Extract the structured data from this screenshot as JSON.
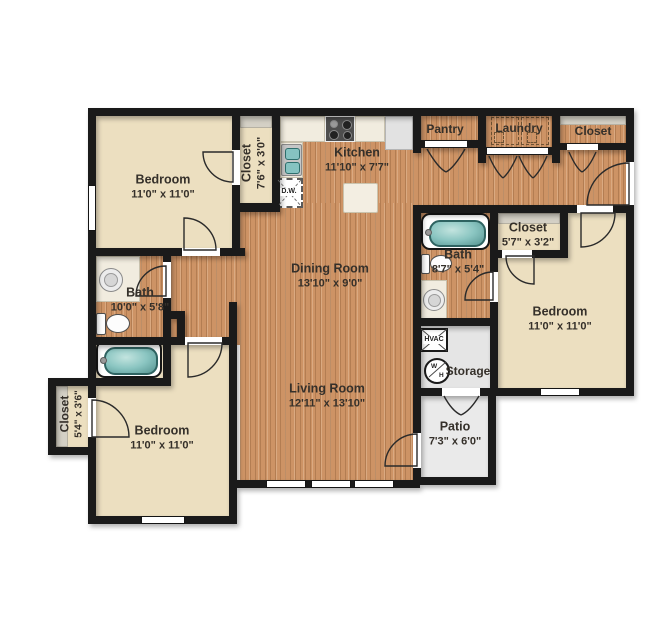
{
  "rooms": {
    "bedroom_tl": {
      "name": "Bedroom",
      "dims": "11'0\" x 11'0\""
    },
    "closet_tl": {
      "name": "Closet",
      "dims": "7'6\" x 3'0\""
    },
    "kitchen": {
      "name": "Kitchen",
      "dims": "11'10\" x 7'7\""
    },
    "pantry": {
      "name": "Pantry"
    },
    "laundry": {
      "name": "Laundry"
    },
    "closet_tr": {
      "name": "Closet"
    },
    "dining": {
      "name": "Dining Room",
      "dims": "13'10\" x 9'0\""
    },
    "living": {
      "name": "Living Room",
      "dims": "12'11\" x 13'10\""
    },
    "bath_l": {
      "name": "Bath",
      "dims": "10'0\" x 5'8\""
    },
    "bath_r": {
      "name": "Bath",
      "dims": "8'7\" x 5'4\""
    },
    "closet_r": {
      "name": "Closet",
      "dims": "5'7\" x 3'2\""
    },
    "bedroom_r": {
      "name": "Bedroom",
      "dims": "11'0\" x 11'0\""
    },
    "storage": {
      "name": "Storage"
    },
    "patio": {
      "name": "Patio",
      "dims": "7'3\" x 6'0\""
    },
    "closet_bl": {
      "name": "Closet",
      "dims": "5'4\" x 3'6\""
    },
    "bedroom_bl": {
      "name": "Bedroom",
      "dims": "11'0\" x 11'0\""
    }
  },
  "fixtures": {
    "dishwasher_label": "D.W.",
    "hvac_label": "HVAC",
    "water_heater_top": "W",
    "water_heater_bottom": "H"
  },
  "colors": {
    "wall": "#1a1a1a",
    "carpet": "#ecdfc0",
    "wood": "#cd9365",
    "tile_gray": "#e5e5e5",
    "tub_teal": "#86c3c1",
    "shelf_gray": "#d4d0c5",
    "background": "#ffffff"
  }
}
